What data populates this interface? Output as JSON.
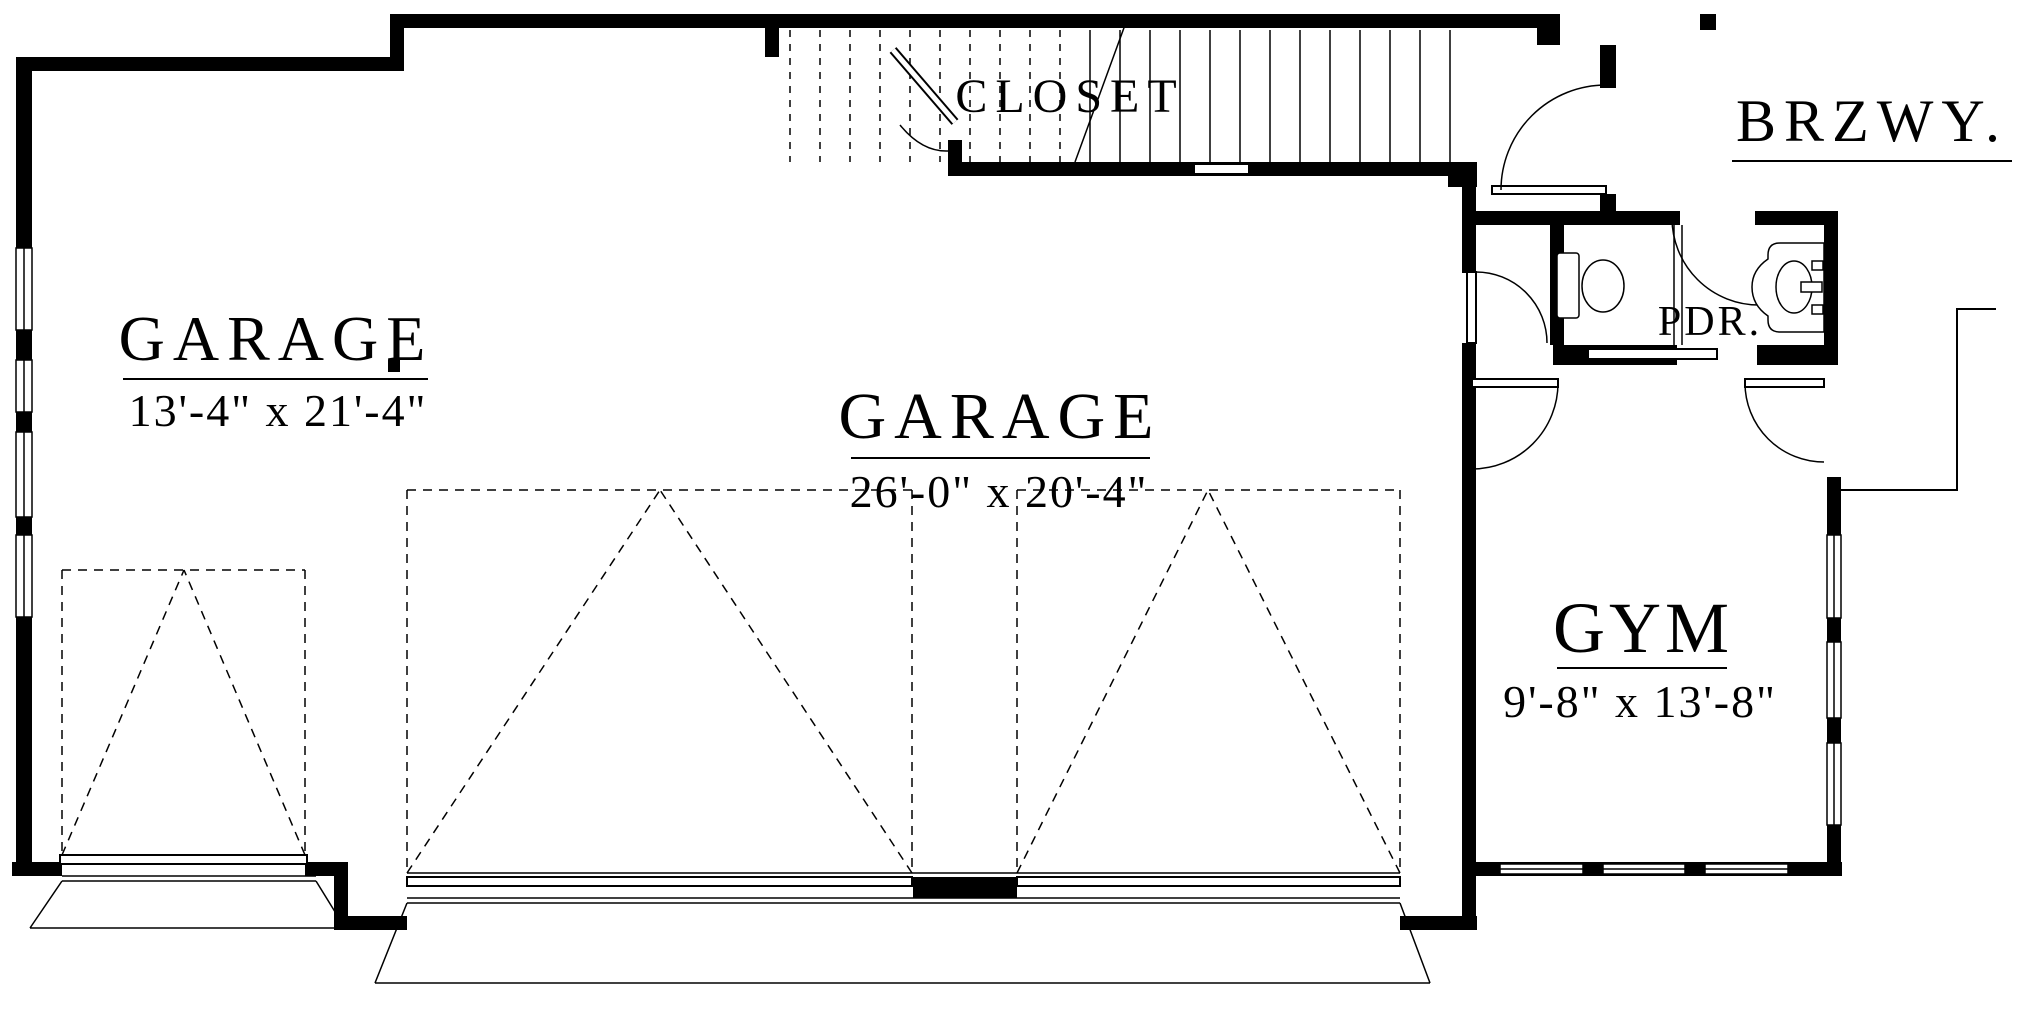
{
  "plan": {
    "type": "floor-plan",
    "colors": {
      "ink": "#000000",
      "paper": "#ffffff"
    },
    "rooms": {
      "closet": {
        "label": "CLOSET"
      },
      "breezeway": {
        "label": "BRZWY."
      },
      "powder_room": {
        "label": "PDR."
      },
      "garage_left": {
        "label": "GARAGE",
        "dimensions": "13'-4\" x 21'-4\""
      },
      "garage_main": {
        "label": "GARAGE",
        "dimensions": "26'-0\" x 20'-4\""
      },
      "gym": {
        "label": "GYM",
        "dimensions": "9'-8\" x 13'-8\""
      }
    },
    "fixtures": [
      "toilet",
      "sink",
      "stairs",
      "garage-doors"
    ]
  }
}
